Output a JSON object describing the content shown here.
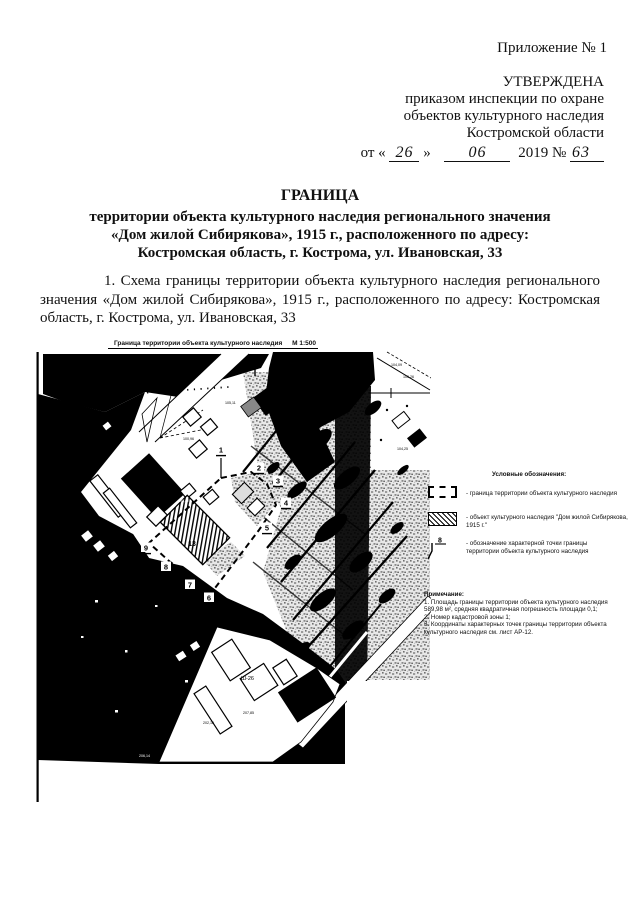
{
  "doc": {
    "appendix_label": "Приложение № 1",
    "approval": {
      "line1": "УТВЕРЖДЕНА",
      "line2": "приказом инспекции по охране",
      "line3": "объектов культурного наследия",
      "line4": "Костромской области",
      "date_prefix": "от «",
      "date_day": "26",
      "date_quote_close": "»",
      "date_month": "06",
      "date_year": "2019 №",
      "date_number": "63"
    },
    "title": {
      "heading": "ГРАНИЦА",
      "line2": "территории объекта культурного наследия регионального значения",
      "line3": "«Дом жилой Сибирякова», 1915 г., расположенного по адресу:",
      "line4": "Костромская область, г. Кострома, ул. Ивановская, 33"
    },
    "paragraph": "1. Схема границы территории объекта культурного наследия регионального значения «Дом жилой Сибирякова», 1915 г., расположенного по адресу: Костромская область, г. Кострома, ул. Ивановская, 33"
  },
  "map": {
    "title": "Граница территории объекта культурного наследия",
    "scale": "М 1:500",
    "points": [
      "1",
      "2",
      "3",
      "4",
      "5",
      "6",
      "7",
      "8",
      "9"
    ],
    "building_label": "13",
    "block_label": "Ш-26",
    "labels": [
      "105,11",
      "100,96",
      "108,82",
      "104,09",
      "105,26",
      "104,25",
      "207,85",
      "202,16",
      "206,14"
    ]
  },
  "legend": {
    "heading": "Условные обозначения:",
    "items": [
      {
        "symbol": "dashed-boundary-icon",
        "caption": "- граница территории объекта культурного наследия"
      },
      {
        "symbol": "hatched-object-icon",
        "caption": "- объект культурного наследия \"Дом жилой Сибирякова, 1915 г.\""
      },
      {
        "symbol": "boundary-point-icon",
        "point_number": "8",
        "caption": "- обозначение характерной точки границы территории объекта культурного наследия"
      }
    ]
  },
  "notes": {
    "heading": "Примечание:",
    "items": [
      "1. Площадь границы территории объекта культурного наследия 589,98 м², средняя квадратичная погрешность площади 0,1;",
      "2. Номер кадастровой зоны 1;",
      "3. Координаты характерных точек границы территории объекта культурного наследия см. лист АР-12."
    ]
  }
}
